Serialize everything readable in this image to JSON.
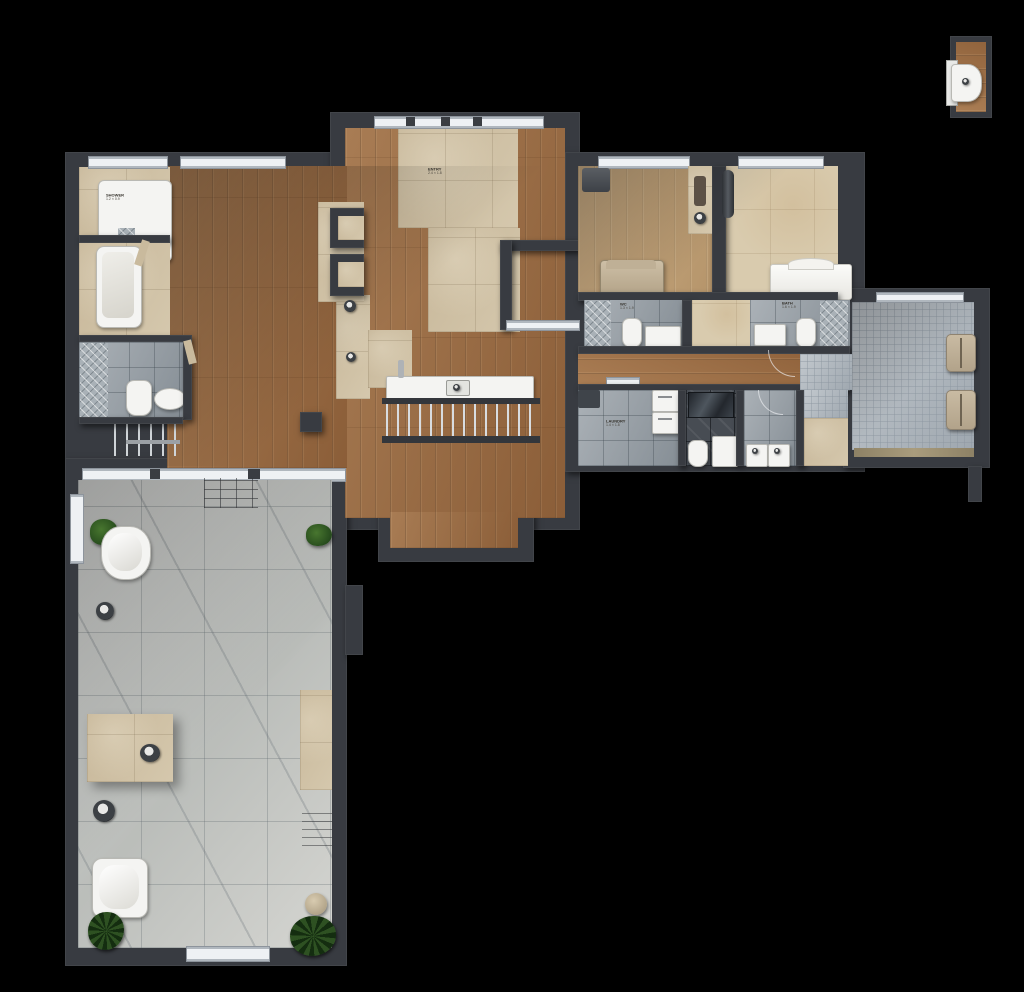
{
  "meta": {
    "title": "residential-floor-plan-top-view",
    "canvas": {
      "width": 1024,
      "height": 992,
      "background": "#000000"
    }
  },
  "palette": {
    "wall": "#383b41",
    "wood_floor": "#9a6a41",
    "light_wood_floor": "#c2a176",
    "travertine": "#cfc1a5",
    "marble": "#c7c9c6",
    "mosaic_tile": "#afb7be",
    "gray_tile": "#969ea5",
    "dark_tile": "#474c53",
    "fixture_white": "#f4f4f2",
    "plant_green": "#2e5122"
  },
  "labels": {
    "shower": {
      "l1": "SHOWER",
      "l2": "1.2 × 0.9"
    },
    "entry": {
      "l1": "ENTRY",
      "l2": "2.4 × 1.8"
    },
    "bath_left": {
      "l1": "WC",
      "l2": "1.3 × 1.9"
    },
    "bath_right": {
      "l1": "BATH",
      "l2": "1.6 × 1.9"
    },
    "laundry": {
      "l1": "LAUNDRY",
      "l2": "1.4 × 1.8"
    }
  },
  "rooms": [
    {
      "name": "shower-room",
      "floor": "travertine"
    },
    {
      "name": "bathtub-room",
      "floor": "travertine"
    },
    {
      "name": "bathroom-left",
      "floor": "gray-tile"
    },
    {
      "name": "living-area",
      "floor": "wood"
    },
    {
      "name": "entry-hall",
      "floor": "travertine-and-wood"
    },
    {
      "name": "kitchen-counter-area",
      "floor": "wood"
    },
    {
      "name": "stair-opening-with-railing",
      "floor": "wood"
    },
    {
      "name": "bedroom-left",
      "floor": "light-wood"
    },
    {
      "name": "bedroom-right",
      "floor": "beige-stone"
    },
    {
      "name": "ensuite-left",
      "floor": "gray-tile"
    },
    {
      "name": "ensuite-right",
      "floor": "gray-tile"
    },
    {
      "name": "hallway",
      "floor": "wood"
    },
    {
      "name": "laundry-room",
      "floor": "gray-tile"
    },
    {
      "name": "dark-shower-wc",
      "floor": "dark-tile"
    },
    {
      "name": "washroom",
      "floor": "gray-tile"
    },
    {
      "name": "balcony-terrace",
      "floor": "mosaic-tile"
    },
    {
      "name": "spa-terrace",
      "floor": "marble"
    }
  ],
  "fixtures": [
    "shower-tray",
    "bathtub",
    "toilet",
    "bidet",
    "kitchen-sink",
    "faucet",
    "stair-railing",
    "bed-left",
    "bed-right",
    "wardrobe",
    "radiator",
    "washer-dryer-stack",
    "vanity-sink",
    "double-sinks",
    "sauna-bench",
    "lounge-chair",
    "lounge-chair",
    "freestanding-tub",
    "soaking-tub",
    "stone-table",
    "round-sink",
    "wall-knob",
    "stool",
    "potted-plant",
    "palm-plant",
    "wall-hung-basin-module"
  ]
}
